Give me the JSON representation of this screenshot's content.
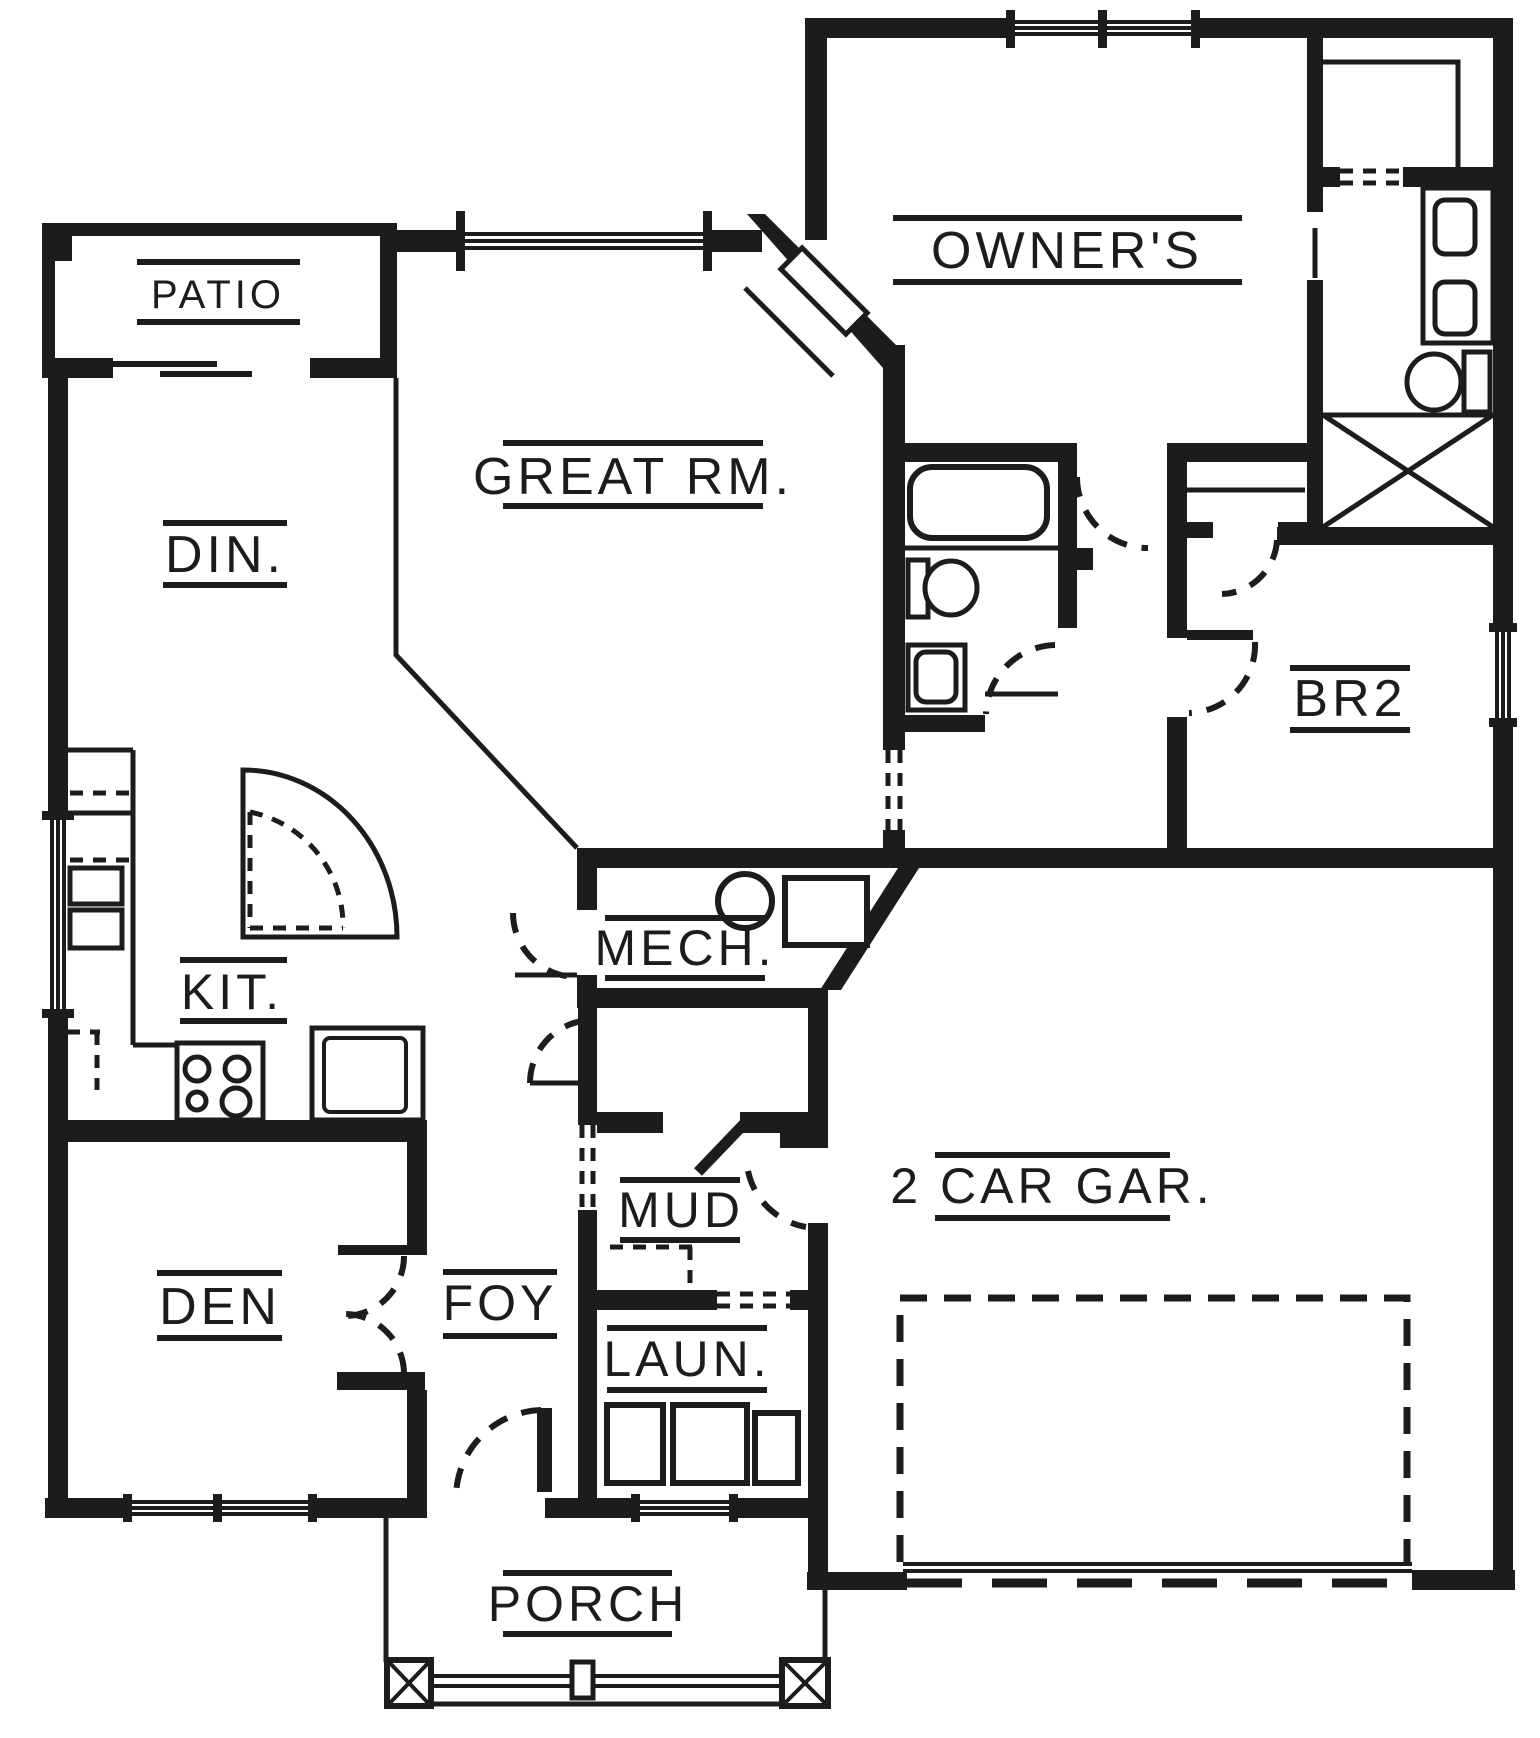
{
  "document": {
    "type": "floor-plan",
    "style": "black-line architectural drawing"
  },
  "colors": {
    "line": "#1c1c1c",
    "background": "#ffffff"
  },
  "rooms": [
    {
      "id": "patio",
      "name": "PATIO"
    },
    {
      "id": "dining",
      "name": "DIN."
    },
    {
      "id": "great-room",
      "name": "GREAT RM."
    },
    {
      "id": "owners-bedroom",
      "name": "OWNER'S"
    },
    {
      "id": "kitchen",
      "name": "KIT."
    },
    {
      "id": "mechanical",
      "name": "MECH."
    },
    {
      "id": "bedroom-2",
      "name": "BR2"
    },
    {
      "id": "den",
      "name": "DEN"
    },
    {
      "id": "foyer",
      "name": "FOY"
    },
    {
      "id": "mud-room",
      "name": "MUD"
    },
    {
      "id": "laundry",
      "name": "LAUN."
    },
    {
      "id": "garage",
      "name": "2 CAR GAR."
    },
    {
      "id": "porch",
      "name": "PORCH"
    }
  ],
  "fixtures": [
    "bathtub",
    "toilet",
    "sink",
    "double-vanity",
    "washer",
    "dryer",
    "laundry-tub",
    "range",
    "kitchen-sink",
    "refrigerator",
    "water-heater",
    "furnace",
    "corner-pantry",
    "corner-fireplace",
    "linen-closet",
    "walk-in-closet",
    "garage-door",
    "porch-posts"
  ]
}
